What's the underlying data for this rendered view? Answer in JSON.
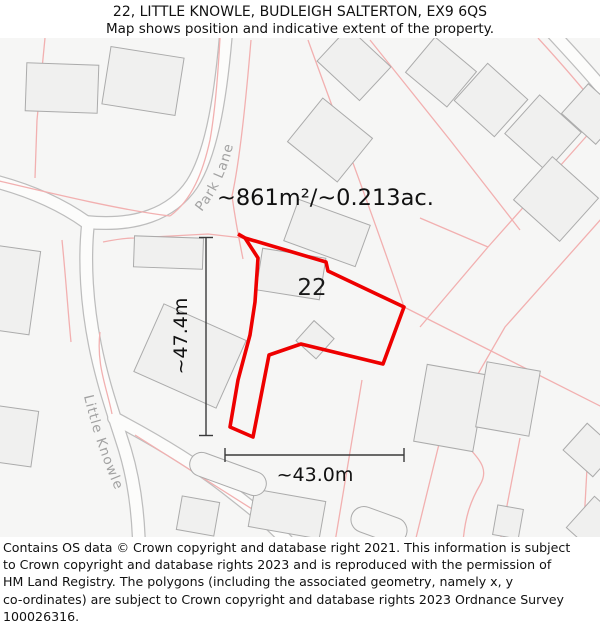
{
  "header": {
    "title": "22, LITTLE KNOWLE, BUDLEIGH SALTERTON, EX9 6QS",
    "subtitle": "Map shows position and indicative extent of the property."
  },
  "map": {
    "property_number": "22",
    "area_label": "~861m²/~0.213ac.",
    "height_label": "~47.4m",
    "width_label": "~43.0m",
    "road_labels": {
      "park_lane": "Park Lane",
      "little_knowle": "Little Knowle"
    },
    "colors": {
      "property_outline": "#ee0000",
      "parcel_line": "#f2b0b0",
      "building_fill": "#f0f0ef",
      "building_stroke": "#ababab",
      "road_fill": "#fcfcfb",
      "road_casing": "#bdbdbd",
      "map_background": "#f6f6f5",
      "road_label_text": "#a2a2a2",
      "dimension": "#3a3a3a"
    }
  },
  "footer": {
    "lines": [
      "Contains OS data © Crown copyright and database right 2021. This information is subject",
      "to Crown copyright and database rights 2023 and is reproduced with the permission of",
      "HM Land Registry. The polygons (including the associated geometry, namely x, y",
      "co-ordinates) are subject to Crown copyright and database rights 2023 Ordnance Survey",
      "100026316."
    ]
  }
}
